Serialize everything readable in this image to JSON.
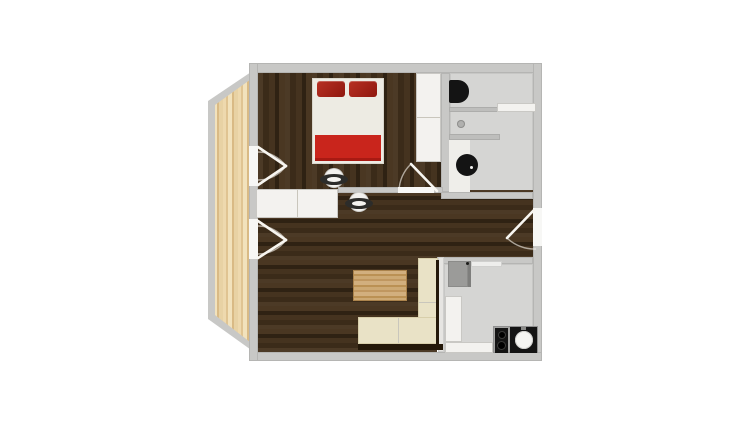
{
  "app": {
    "type": "floor-plan-viewer",
    "visible_text": "none"
  },
  "colors": {
    "canvas": "#ffffff",
    "wall": "#c8c8c6",
    "door_opening": "#f7f7f5",
    "wood_dark": "#42301d",
    "wood_light": "#e8d2a4",
    "tile_gray": "#d5d5d3",
    "furniture_white": "#f3f2ef",
    "furniture_border": "#c9c8c4",
    "sofa": "#e9e2c6",
    "sofa_border": "#d8cfab",
    "table_tan": "#c69f68",
    "bed_linen": "#edebe3",
    "pillow_red": "#8f170e",
    "blanket_red": "#c9251c",
    "appliance_black": "#141414",
    "appliance_gray": "#9b9b99"
  },
  "rooms": {
    "bedroom": "Bedroom (dark wood floor, top left)",
    "bathroom": "Bathroom (gray floor, top right)",
    "hallway": "Hallway (dark wood, center strip)",
    "living": "Living room (dark wood, bottom left)",
    "kitchen": "Kitchen (gray floor, bottom right)",
    "balcony": "Balcony (light wood deck, angled, left)"
  },
  "fixtures": {
    "bed": "Double bed with two red pillows and red blanket",
    "wardrobe": "Wardrobe column beside bed",
    "sideboard": "Hallway sideboard cabinets",
    "side_table_1": "Round side table (bedroom)",
    "side_table_2": "Round side table (hallway)",
    "toilet": "Wall-hung toilet, black seat",
    "shower_shelf": "Bathroom shelf",
    "shower_drain": "Shower drain",
    "washer": "Washing machine, black round door",
    "fridge": "Refrigerator",
    "kitchen_counter": "L-shaped white kitchen counter",
    "worktop": "Worktop with cooktop and sink",
    "cooktop": "Two-burner cooktop",
    "sink": "Round kitchen sink",
    "sofa": "Corner sofa, cream",
    "coffee_table": "Wooden coffee table",
    "balcony_door_bedroom": "Double balcony door (bedroom)",
    "balcony_door_living": "Double balcony door (living room)",
    "bedroom_door": "Bedroom door to hallway",
    "entrance_door": "Entrance door, right wall"
  }
}
